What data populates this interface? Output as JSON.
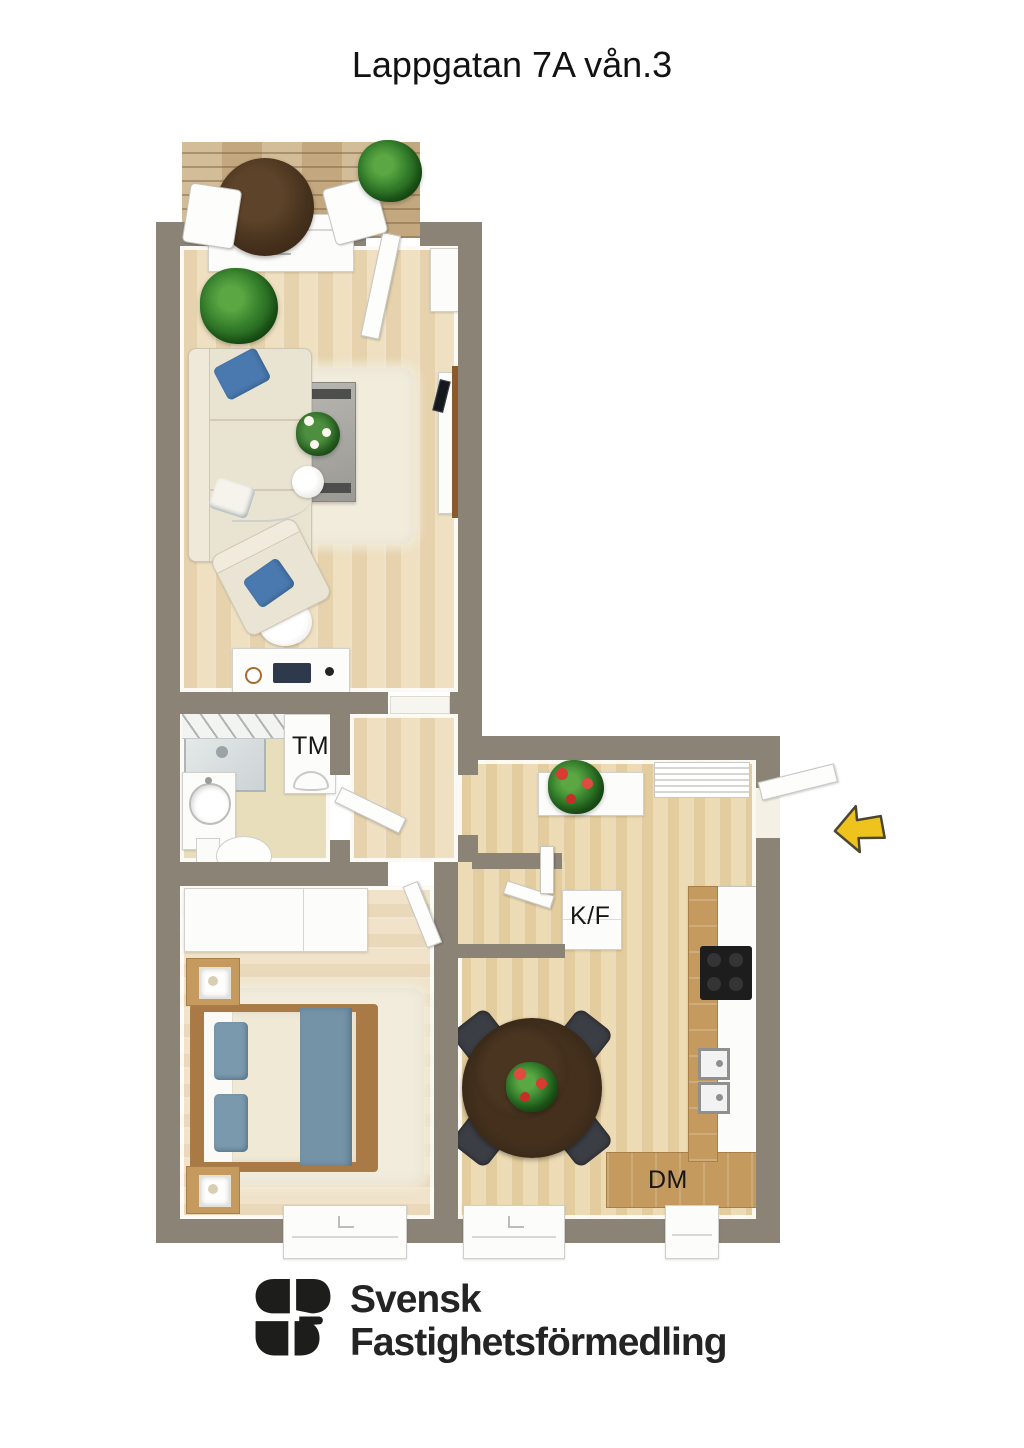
{
  "page": {
    "title": "Lappgatan 7A vån.3"
  },
  "floorplan": {
    "appliance_labels": {
      "washing_machine": "TM",
      "fridge_freezer": "K/F",
      "dishwasher": "DM"
    },
    "entrance": {
      "arrow_icon": "left-arrow",
      "arrow_color": "#eec31e"
    },
    "colors": {
      "wall": "#8b8476",
      "living_floor": "#ecdcb9",
      "bedroom_floor": "#eee0c4",
      "kitchen_floor": "#ead7ab",
      "bathroom_floor": "#e9debc",
      "balcony_deck": "#cdb38a",
      "accent_blue": "#7b99ad",
      "counter_wood": "#c49a5f"
    }
  },
  "footer_logo": {
    "line1": "Svensk",
    "line2": "Fastighetsförmedling"
  }
}
